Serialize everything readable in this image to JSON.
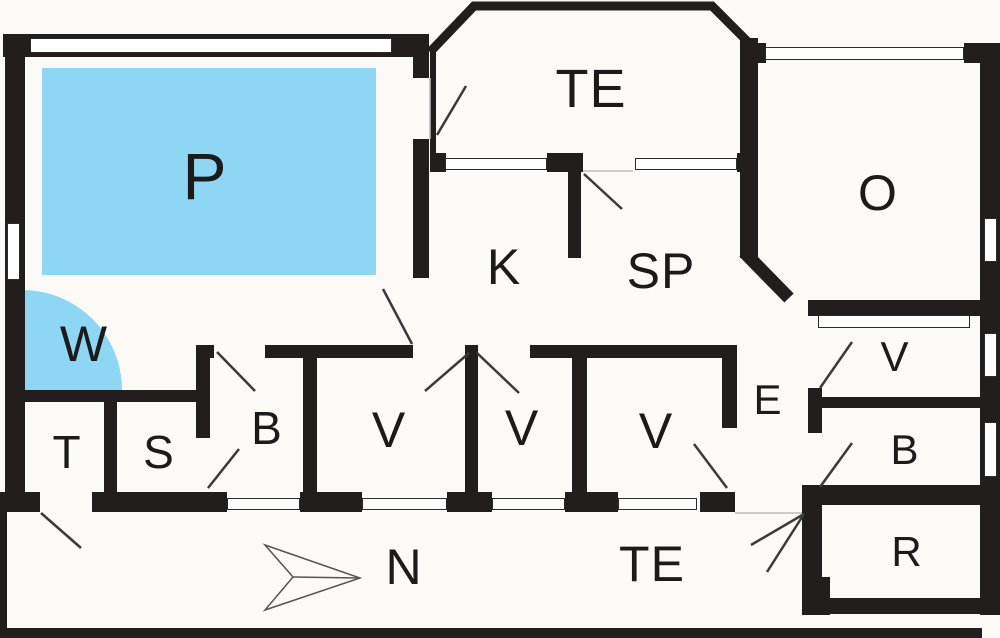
{
  "plan": {
    "canvas": {
      "width": 1000,
      "height": 638
    },
    "colors": {
      "background": "#fbfaf7",
      "wall": "#221e1e",
      "pool_blue": "#8dd6f4",
      "window_fill": "#ffffff",
      "window_border": "#2a2a2a",
      "door_line": "#3a3a3a",
      "threshold_line": "#bdbdbd",
      "arrow_line": "#555555",
      "text": "#1b1b1b"
    },
    "labels": [
      {
        "id": "p",
        "text": "P",
        "x": 205,
        "y": 176,
        "size": 66
      },
      {
        "id": "te-top",
        "text": "TE",
        "x": 591,
        "y": 89,
        "size": 54
      },
      {
        "id": "o",
        "text": "O",
        "x": 878,
        "y": 193,
        "size": 50
      },
      {
        "id": "k",
        "text": "K",
        "x": 504,
        "y": 267,
        "size": 50
      },
      {
        "id": "sp",
        "text": "SP",
        "x": 661,
        "y": 271,
        "size": 50
      },
      {
        "id": "w",
        "text": "W",
        "x": 84,
        "y": 344,
        "size": 50
      },
      {
        "id": "t",
        "text": "T",
        "x": 67,
        "y": 452,
        "size": 46
      },
      {
        "id": "s",
        "text": "S",
        "x": 159,
        "y": 452,
        "size": 46
      },
      {
        "id": "b-left",
        "text": "B",
        "x": 267,
        "y": 428,
        "size": 46
      },
      {
        "id": "v1",
        "text": "V",
        "x": 389,
        "y": 430,
        "size": 50
      },
      {
        "id": "v2",
        "text": "V",
        "x": 522,
        "y": 428,
        "size": 50
      },
      {
        "id": "v3",
        "text": "V",
        "x": 656,
        "y": 431,
        "size": 50
      },
      {
        "id": "e",
        "text": "E",
        "x": 768,
        "y": 400,
        "size": 42
      },
      {
        "id": "v-right",
        "text": "V",
        "x": 895,
        "y": 357,
        "size": 42
      },
      {
        "id": "b-right",
        "text": "B",
        "x": 905,
        "y": 450,
        "size": 42
      },
      {
        "id": "r",
        "text": "R",
        "x": 907,
        "y": 552,
        "size": 42
      },
      {
        "id": "te-bottom",
        "text": "TE",
        "x": 652,
        "y": 564,
        "size": 50
      },
      {
        "id": "n",
        "text": "N",
        "x": 404,
        "y": 567,
        "size": 50
      }
    ],
    "walls": [
      {
        "x": 3,
        "y": 34,
        "w": 425,
        "h": 23
      },
      {
        "x": 5,
        "y": 34,
        "w": 20,
        "h": 458
      },
      {
        "x": 5,
        "y": 390,
        "w": 205,
        "h": 12
      },
      {
        "x": 413,
        "y": 34,
        "w": 16,
        "h": 44
      },
      {
        "x": 413,
        "y": 139,
        "w": 16,
        "h": 139
      },
      {
        "x": 198,
        "y": 345,
        "w": 16,
        "h": 13
      },
      {
        "x": 265,
        "y": 345,
        "w": 148,
        "h": 13
      },
      {
        "x": 530,
        "y": 345,
        "w": 207,
        "h": 13
      },
      {
        "x": 465,
        "y": 345,
        "w": 13,
        "h": 152
      },
      {
        "x": 196,
        "y": 345,
        "w": 14,
        "h": 93
      },
      {
        "x": 104,
        "y": 400,
        "w": 13,
        "h": 93
      },
      {
        "x": 303,
        "y": 345,
        "w": 14,
        "h": 150
      },
      {
        "x": 572,
        "y": 345,
        "w": 15,
        "h": 150
      },
      {
        "x": 722,
        "y": 345,
        "w": 15,
        "h": 83
      },
      {
        "x": 0,
        "y": 492,
        "w": 40,
        "h": 20
      },
      {
        "x": 92,
        "y": 492,
        "w": 135,
        "h": 20
      },
      {
        "x": 300,
        "y": 492,
        "w": 62,
        "h": 20
      },
      {
        "x": 447,
        "y": 492,
        "w": 45,
        "h": 20
      },
      {
        "x": 565,
        "y": 492,
        "w": 53,
        "h": 20
      },
      {
        "x": 700,
        "y": 492,
        "w": 35,
        "h": 20
      },
      {
        "x": 430,
        "y": 153,
        "w": 16,
        "h": 19
      },
      {
        "x": 547,
        "y": 153,
        "w": 36,
        "h": 19
      },
      {
        "x": 737,
        "y": 153,
        "w": 20,
        "h": 19
      },
      {
        "x": 568,
        "y": 172,
        "w": 13,
        "h": 86
      },
      {
        "x": 430,
        "y": 47,
        "w": 6,
        "h": 107
      },
      {
        "x": 740,
        "y": 38,
        "w": 18,
        "h": 220
      },
      {
        "x": 740,
        "y": 43,
        "w": 26,
        "h": 20
      },
      {
        "x": 964,
        "y": 43,
        "w": 36,
        "h": 20
      },
      {
        "x": 980,
        "y": 43,
        "w": 20,
        "h": 572
      },
      {
        "x": 808,
        "y": 300,
        "w": 192,
        "h": 16
      },
      {
        "x": 808,
        "y": 388,
        "w": 14,
        "h": 45
      },
      {
        "x": 808,
        "y": 397,
        "w": 192,
        "h": 11
      },
      {
        "x": 802,
        "y": 485,
        "w": 198,
        "h": 20
      },
      {
        "x": 802,
        "y": 485,
        "w": 20,
        "h": 92
      },
      {
        "x": 802,
        "y": 577,
        "w": 28,
        "h": 38
      },
      {
        "x": 815,
        "y": 598,
        "w": 165,
        "h": 16
      },
      {
        "x": 0,
        "y": 492,
        "w": 7,
        "h": 146
      },
      {
        "x": 0,
        "y": 628,
        "w": 982,
        "h": 10
      }
    ],
    "windows": [
      {
        "x": 30,
        "y": 38,
        "w": 362,
        "h": 15
      },
      {
        "x": 7,
        "y": 223,
        "w": 13,
        "h": 57
      },
      {
        "x": 445,
        "y": 158,
        "w": 102,
        "h": 12
      },
      {
        "x": 635,
        "y": 158,
        "w": 102,
        "h": 12
      },
      {
        "x": 765,
        "y": 47,
        "w": 199,
        "h": 13
      },
      {
        "x": 984,
        "y": 218,
        "w": 13,
        "h": 44
      },
      {
        "x": 984,
        "y": 333,
        "w": 13,
        "h": 44
      },
      {
        "x": 984,
        "y": 422,
        "w": 13,
        "h": 55
      },
      {
        "x": 818,
        "y": 315,
        "w": 152,
        "h": 13
      },
      {
        "x": 227,
        "y": 498,
        "w": 73,
        "h": 12
      },
      {
        "x": 362,
        "y": 498,
        "w": 85,
        "h": 12
      },
      {
        "x": 492,
        "y": 498,
        "w": 73,
        "h": 12
      },
      {
        "x": 618,
        "y": 498,
        "w": 79,
        "h": 12
      }
    ],
    "doors": [
      {
        "x1": 437,
        "y1": 135,
        "x2": 466,
        "y2": 86
      },
      {
        "x1": 584,
        "y1": 174,
        "x2": 622,
        "y2": 209
      },
      {
        "x1": 412,
        "y1": 344,
        "x2": 383,
        "y2": 289
      },
      {
        "x1": 217,
        "y1": 352,
        "x2": 255,
        "y2": 391
      },
      {
        "x1": 208,
        "y1": 488,
        "x2": 239,
        "y2": 449
      },
      {
        "x1": 469,
        "y1": 353,
        "x2": 425,
        "y2": 391
      },
      {
        "x1": 477,
        "y1": 353,
        "x2": 519,
        "y2": 393
      },
      {
        "x1": 727,
        "y1": 488,
        "x2": 694,
        "y2": 444
      },
      {
        "x1": 820,
        "y1": 388,
        "x2": 852,
        "y2": 342
      },
      {
        "x1": 820,
        "y1": 487,
        "x2": 852,
        "y2": 443
      },
      {
        "x1": 41,
        "y1": 513,
        "x2": 81,
        "y2": 548
      },
      {
        "x1": 804,
        "y1": 514,
        "x2": 751,
        "y2": 545
      },
      {
        "x1": 804,
        "y1": 514,
        "x2": 767,
        "y2": 572
      }
    ],
    "thresholds": [
      {
        "x1": 583,
        "y1": 171,
        "x2": 633,
        "y2": 171
      },
      {
        "x1": 735,
        "y1": 513,
        "x2": 802,
        "y2": 513
      },
      {
        "x1": 430,
        "y1": 78,
        "x2": 430,
        "y2": 139
      }
    ],
    "pool": {
      "x": 42,
      "y": 68,
      "w": 334,
      "h": 207
    },
    "whirlpool_corner": {
      "x": 22,
      "y": 290,
      "r": 100
    },
    "bay_outline": {
      "points": "430,52 474,6 712,6 754,48",
      "stroke_width": 9
    },
    "chimney": {
      "x1": 744,
      "y1": 252,
      "x2": 789,
      "y2": 298,
      "stroke_width": 13
    },
    "north_arrow": {
      "polygon": "265,545 360,578 265,610 293,577",
      "midline": {
        "x1": 293,
        "y1": 577,
        "x2": 360,
        "y2": 578
      }
    }
  }
}
